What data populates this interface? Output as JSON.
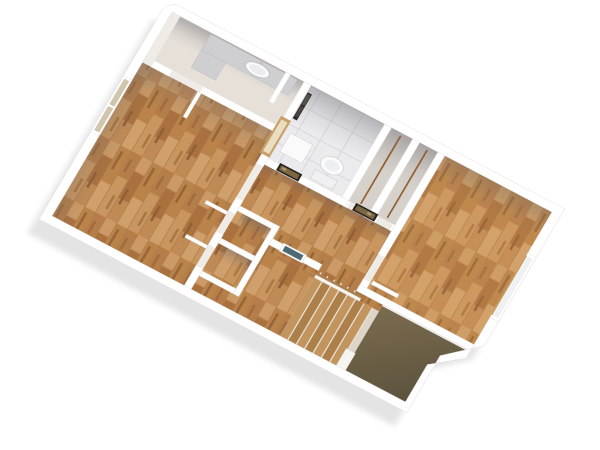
{
  "scene": {
    "kind": "3d-floor-plan-render",
    "view": "isometric-top-down",
    "background": "#ffffff"
  },
  "colors": {
    "wall": "#ffffff",
    "wall_edge": "#e7e3df",
    "slab": "#efece8",
    "shadow": "#c6c4c6",
    "wood_base": "#c08a55",
    "wood_dark": "#a06b3e",
    "wood_mid": "#b57e49",
    "wood_light": "#d0a06c",
    "bedroom_tint": "#f0b36b",
    "bath_floor": "#e6e0d9",
    "tile_base": "#ebebee",
    "tile_grout": "#d8d8dc",
    "closet_floor": "#d6d1cb",
    "rod_wood": "#8f6134",
    "counter": "#cfcfd1",
    "fixture_white": "#fafafa",
    "fixture_edge": "#c9c9cd",
    "mirror_dark": "#2e2b28",
    "frame_dark": "#262220",
    "frame_gold": "#7d6743",
    "art_teal": "#4e6b74",
    "window_glass_tan": "#d2c5ae",
    "window_glass_cool": "#eef0f2",
    "window_trim": "#c9a06a",
    "tread_light": "#c2955f",
    "tread_dark": "#ad7f49",
    "stringer": "#ddd5c8",
    "stair_base": "#e8e1d6",
    "ramp_dark_1": "#7a6c4e",
    "ramp_dark_2": "#574e3a",
    "railing_wood": "#a9814e",
    "railing_white": "#f7f5f2",
    "shade_tone": "#64646c"
  },
  "rooms": [
    {
      "id": "living-room-west",
      "floor": "wood-parquet"
    },
    {
      "id": "bathroom-vanity",
      "floor": "greige"
    },
    {
      "id": "bathroom-wc",
      "floor": "white-tile"
    },
    {
      "id": "wardrobe-a",
      "floor": "gray"
    },
    {
      "id": "wardrobe-b",
      "floor": "gray"
    },
    {
      "id": "bedroom-east",
      "floor": "wood-parquet"
    },
    {
      "id": "hallway",
      "floor": "wood-parquet"
    },
    {
      "id": "closet-a",
      "floor": "wood-parquet"
    },
    {
      "id": "closet-b",
      "floor": "wood-parquet"
    },
    {
      "id": "stairwell",
      "floor": "wood-stairs"
    }
  ],
  "fixtures": [
    {
      "id": "vanity-counter-with-sink"
    },
    {
      "id": "toilet"
    },
    {
      "id": "bath-cabinet"
    },
    {
      "id": "wall-mirror-dark"
    },
    {
      "id": "wardrobe-rod",
      "count": 2
    },
    {
      "id": "framed-picture-gold",
      "count": 2
    },
    {
      "id": "framed-picture-teal",
      "count": 1
    },
    {
      "id": "open-door-leaf",
      "count": 4
    },
    {
      "id": "wood-glass-door",
      "count": 1
    }
  ],
  "windows": [
    {
      "id": "window-northwest-wall",
      "panes": 2,
      "glass": "tan"
    },
    {
      "id": "window-southeast-wall",
      "panes": 1,
      "glass": "cool"
    }
  ],
  "stairs": {
    "visible_treads": 7,
    "has_railing": true,
    "has_dark_lower_flight": true
  }
}
